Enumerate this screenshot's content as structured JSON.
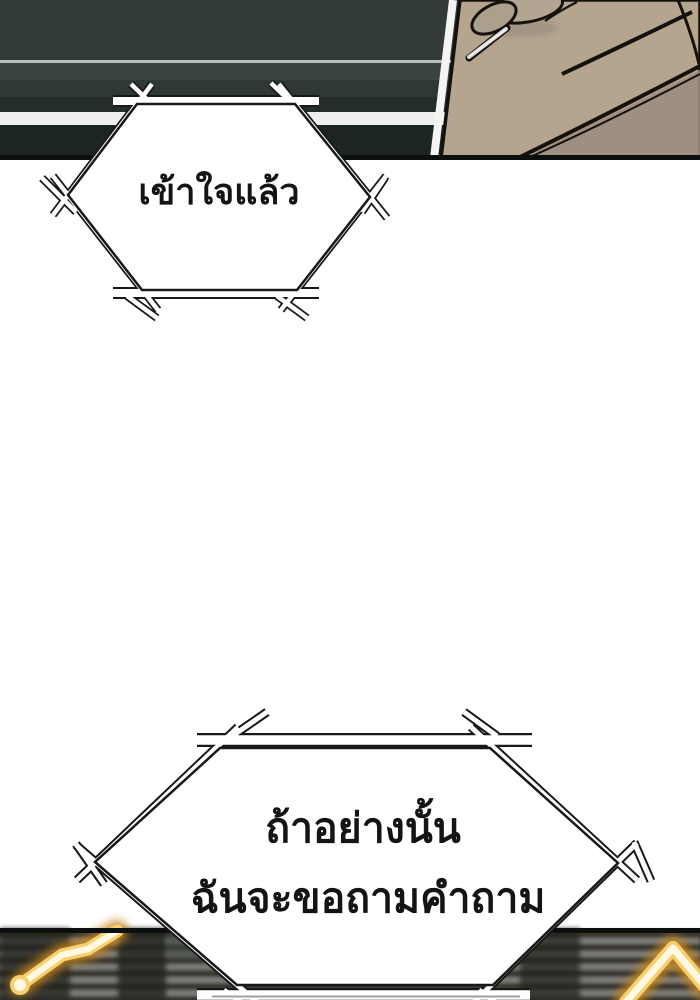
{
  "panel": {
    "kind_label": "webtoon comic panel",
    "speech_bubbles": {
      "bubble_top": {
        "text": "เข้าใจแล้ว"
      },
      "bubble_bottom": {
        "line1": "ถ้าอย่างนั้น",
        "line2": "ฉันจะขอถามคำถาม"
      }
    },
    "colors": {
      "background": "#ffffff",
      "outline": "#181818",
      "panel_top_base": "#323b3a",
      "panel_top_band_light": "#3a4443",
      "panel_top_band_teal": "#2d3837",
      "panel_top_band_dark": "#232d2c",
      "panel_top_deep": "#1d2524",
      "highlight_stripe": "#edf0ef",
      "thin_light_line": "#b7bdbc",
      "border_black": "#0b0f0e",
      "hand_skin": "#b5a48e",
      "hand_skin_shadow": "#9a8d80",
      "hand_knuckle": "#b2a591",
      "stick_light": "#d7d9d6",
      "bottom_panel_base": "#353330",
      "bottom_stripe_light": "#7b7c76",
      "bottom_stripe_dark": "#38362f",
      "glow_core": "#fff8e2",
      "glow_gold": "#f6cf6e",
      "glow_amber": "#c9861e",
      "bar_gray_line": "#a0a0a0",
      "bubble_fill": "#ffffff"
    }
  }
}
